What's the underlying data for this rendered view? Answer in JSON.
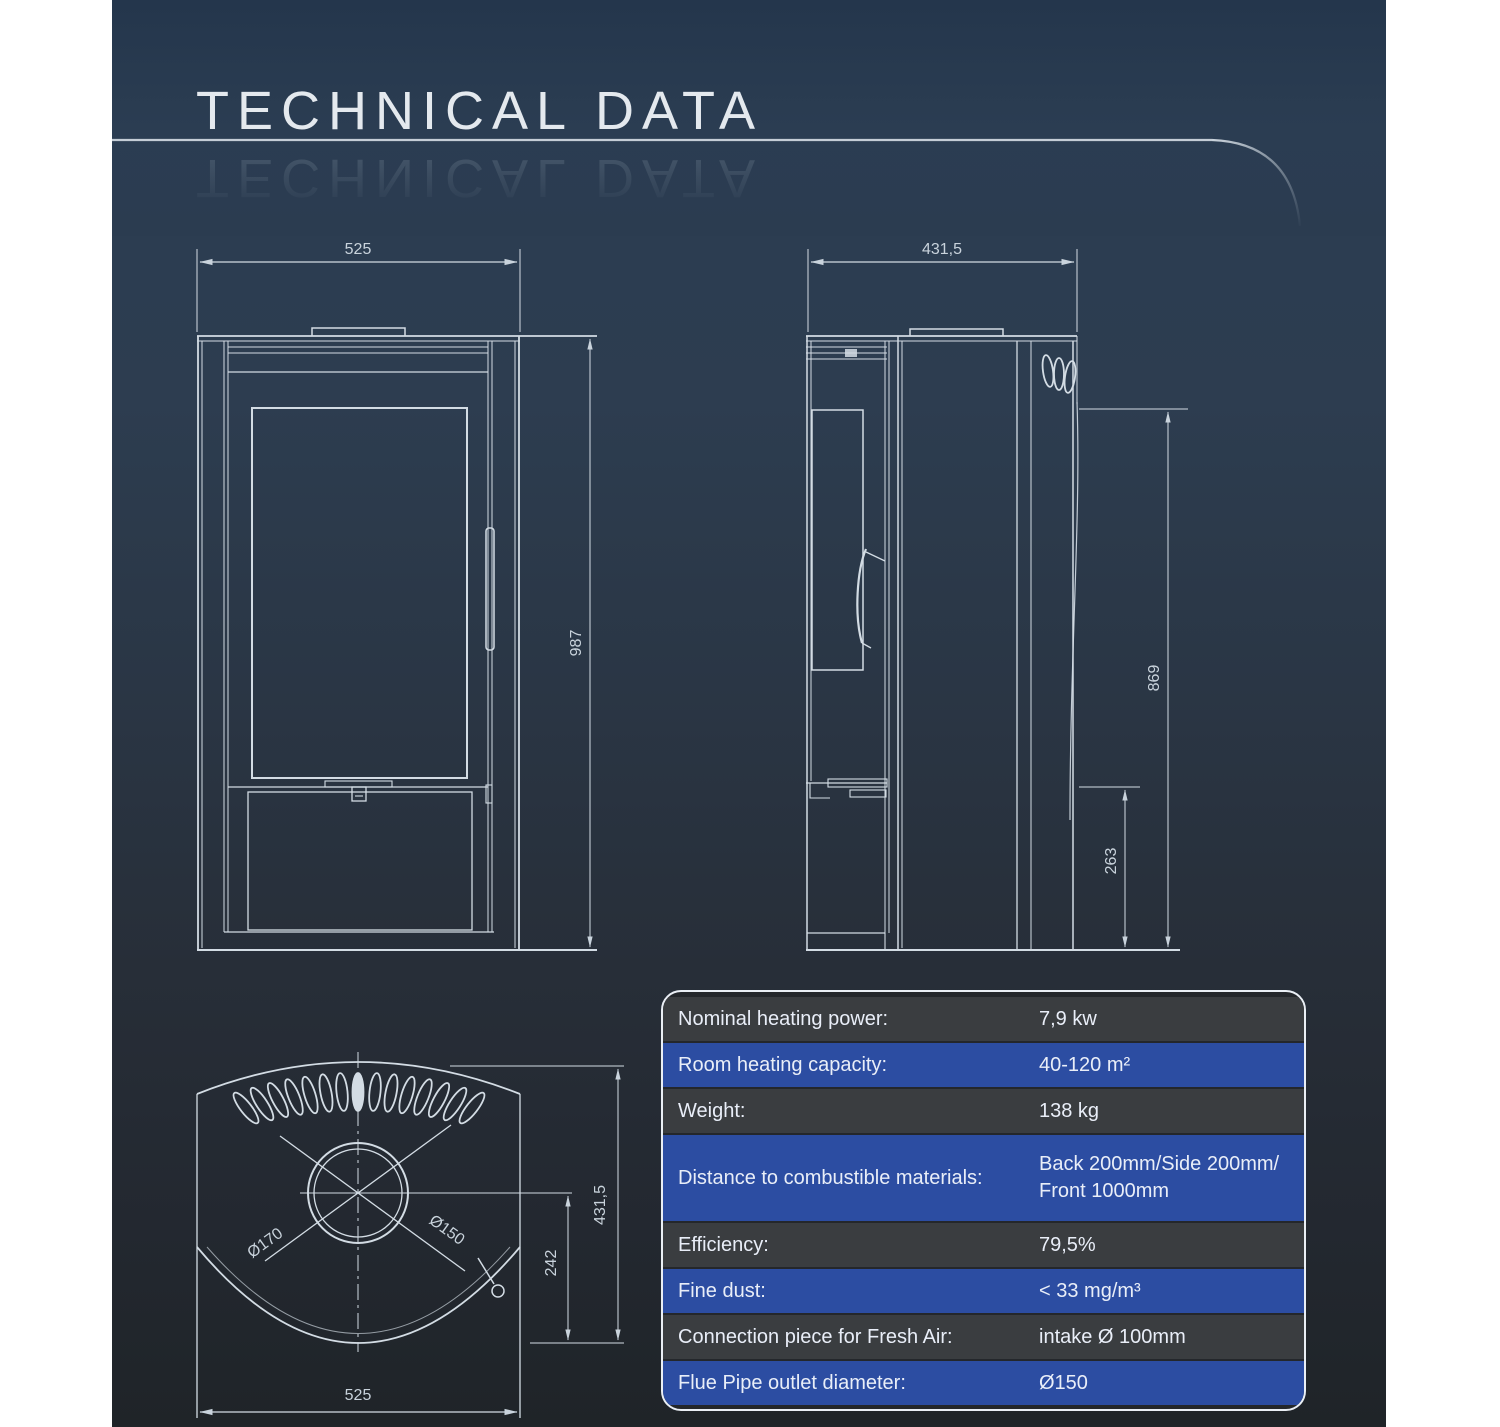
{
  "title": "TECHNICAL DATA",
  "drawings": {
    "front_view": {
      "width": "525",
      "height": "987"
    },
    "side_view": {
      "depth": "431,5",
      "height": "869",
      "plinth_height": "263"
    },
    "top_view": {
      "width": "525",
      "depth": "431,5",
      "flue_center_offset": "242",
      "collar_outer_diameter": "Ø170",
      "collar_inner_diameter": "Ø150"
    }
  },
  "table": {
    "rows": [
      {
        "label": "Nominal heating power:",
        "value": "7,9 kw"
      },
      {
        "label": "Room heating capacity:",
        "value": "40-120 m²"
      },
      {
        "label": "Weight:",
        "value": "138 kg"
      },
      {
        "label": "Distance to combustible materials:",
        "value": "Back 200mm/Side 200mm/",
        "value2": "Front 1000mm"
      },
      {
        "label": "Efficiency:",
        "value": "79,5%"
      },
      {
        "label": "Fine dust:",
        "value": "< 33 mg/m³"
      },
      {
        "label": "Connection piece for Fresh Air:",
        "value": "intake Ø 100mm"
      },
      {
        "label": "Flue Pipe outlet diameter:",
        "value": "Ø150"
      }
    ]
  },
  "colors": {
    "accent_blue": "#2c4da2",
    "row_dark": "#3a3d40",
    "line": "#d3dce4",
    "background_top": "#2b3d52",
    "background_bottom": "#1f2428"
  }
}
